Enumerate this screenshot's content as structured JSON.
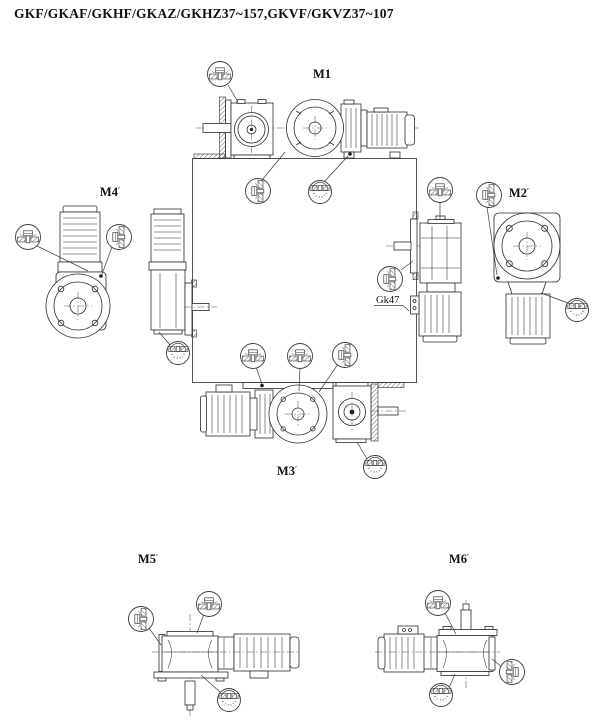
{
  "title": "GKF/GKAF/GKHF/GKAZ/GKHZ37~157,GKVF/GKVZ37~107",
  "positions": [
    {
      "id": "M1",
      "label": "M1",
      "suffix": ""
    },
    {
      "id": "M2",
      "label": "M2",
      "suffix": "′"
    },
    {
      "id": "M3",
      "label": "M3",
      "suffix": "′"
    },
    {
      "id": "M4",
      "label": "M4",
      "suffix": "′"
    },
    {
      "id": "M5",
      "label": "M5",
      "suffix": "′"
    },
    {
      "id": "M6",
      "label": "M6",
      "suffix": "′"
    }
  ],
  "annotations": {
    "gearbox_callout": "Gk47"
  },
  "colors": {
    "line": "#2b2b2b",
    "text": "#111111",
    "background": "#ffffff"
  }
}
